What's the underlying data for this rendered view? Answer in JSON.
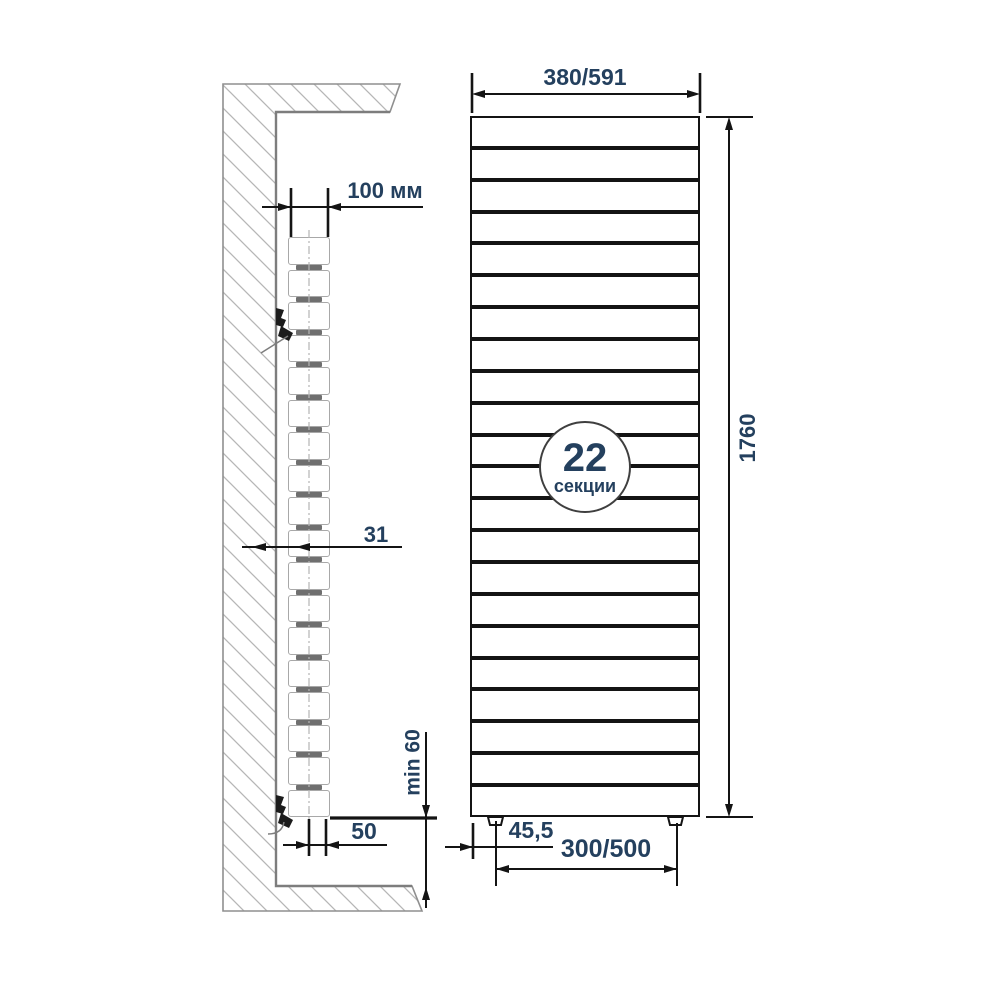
{
  "diagram": {
    "type": "radiator-installation-drawing",
    "front_view": {
      "sections_count": 22,
      "badge": {
        "number": "22",
        "unit": "секции"
      },
      "dimensions": {
        "width": "380/591",
        "height": "1760",
        "foot_inset": "45,5",
        "feet_spacing": "300/500"
      }
    },
    "side_view": {
      "sections_count": 18,
      "dimensions": {
        "wall_clearance": "100 мм",
        "depth": "31",
        "floor_clearance": "min 60",
        "bottom_offset": "50"
      }
    }
  },
  "colors": {
    "line": "#141414",
    "text": "#24405e",
    "wall": "#8f8f8f",
    "hatch": "#b6b6b6"
  }
}
